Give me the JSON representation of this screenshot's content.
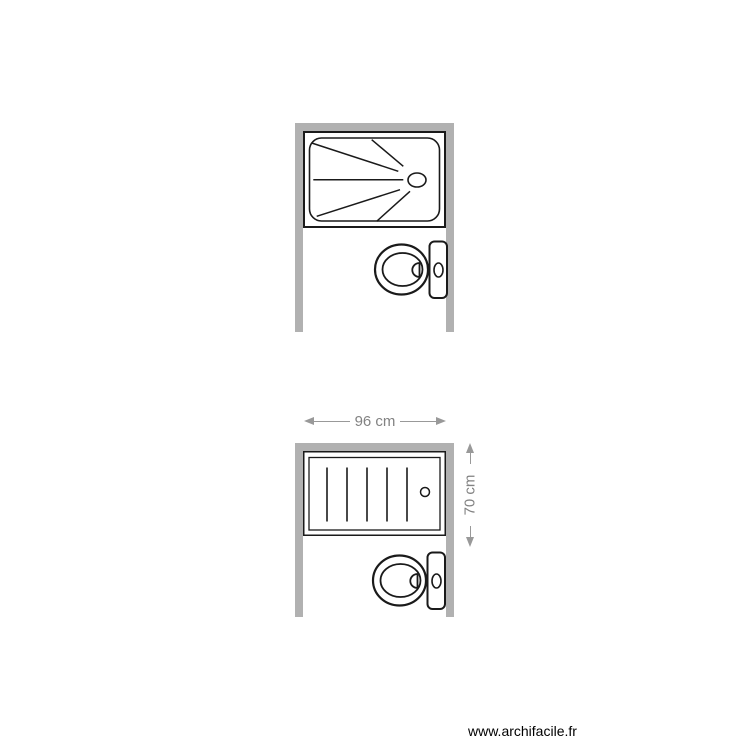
{
  "page": {
    "watermark": "www.archifacile.fr",
    "background": "#ffffff"
  },
  "colors": {
    "wall": "#b1b1b1",
    "outline": "#1a1a1a",
    "dimension_line": "#999999",
    "dimension_text": "#828282",
    "fixture_fill": "#ffffff"
  },
  "plans": [
    {
      "id": "plan-top",
      "walls": [
        "top",
        "left",
        "right"
      ],
      "fixtures": [
        {
          "type": "shower-tray",
          "detail": "spray-lines-with-drain"
        },
        {
          "type": "toilet",
          "detail": "tank-against-right-wall"
        }
      ]
    },
    {
      "id": "plan-bottom",
      "walls": [
        "top",
        "left",
        "right"
      ],
      "dimensions": {
        "width_label": "96 cm",
        "height_label": "70 cm"
      },
      "fixtures": [
        {
          "type": "bathtub",
          "detail": "slatted-with-drain"
        },
        {
          "type": "toilet",
          "detail": "tank-against-right-wall"
        }
      ]
    }
  ]
}
